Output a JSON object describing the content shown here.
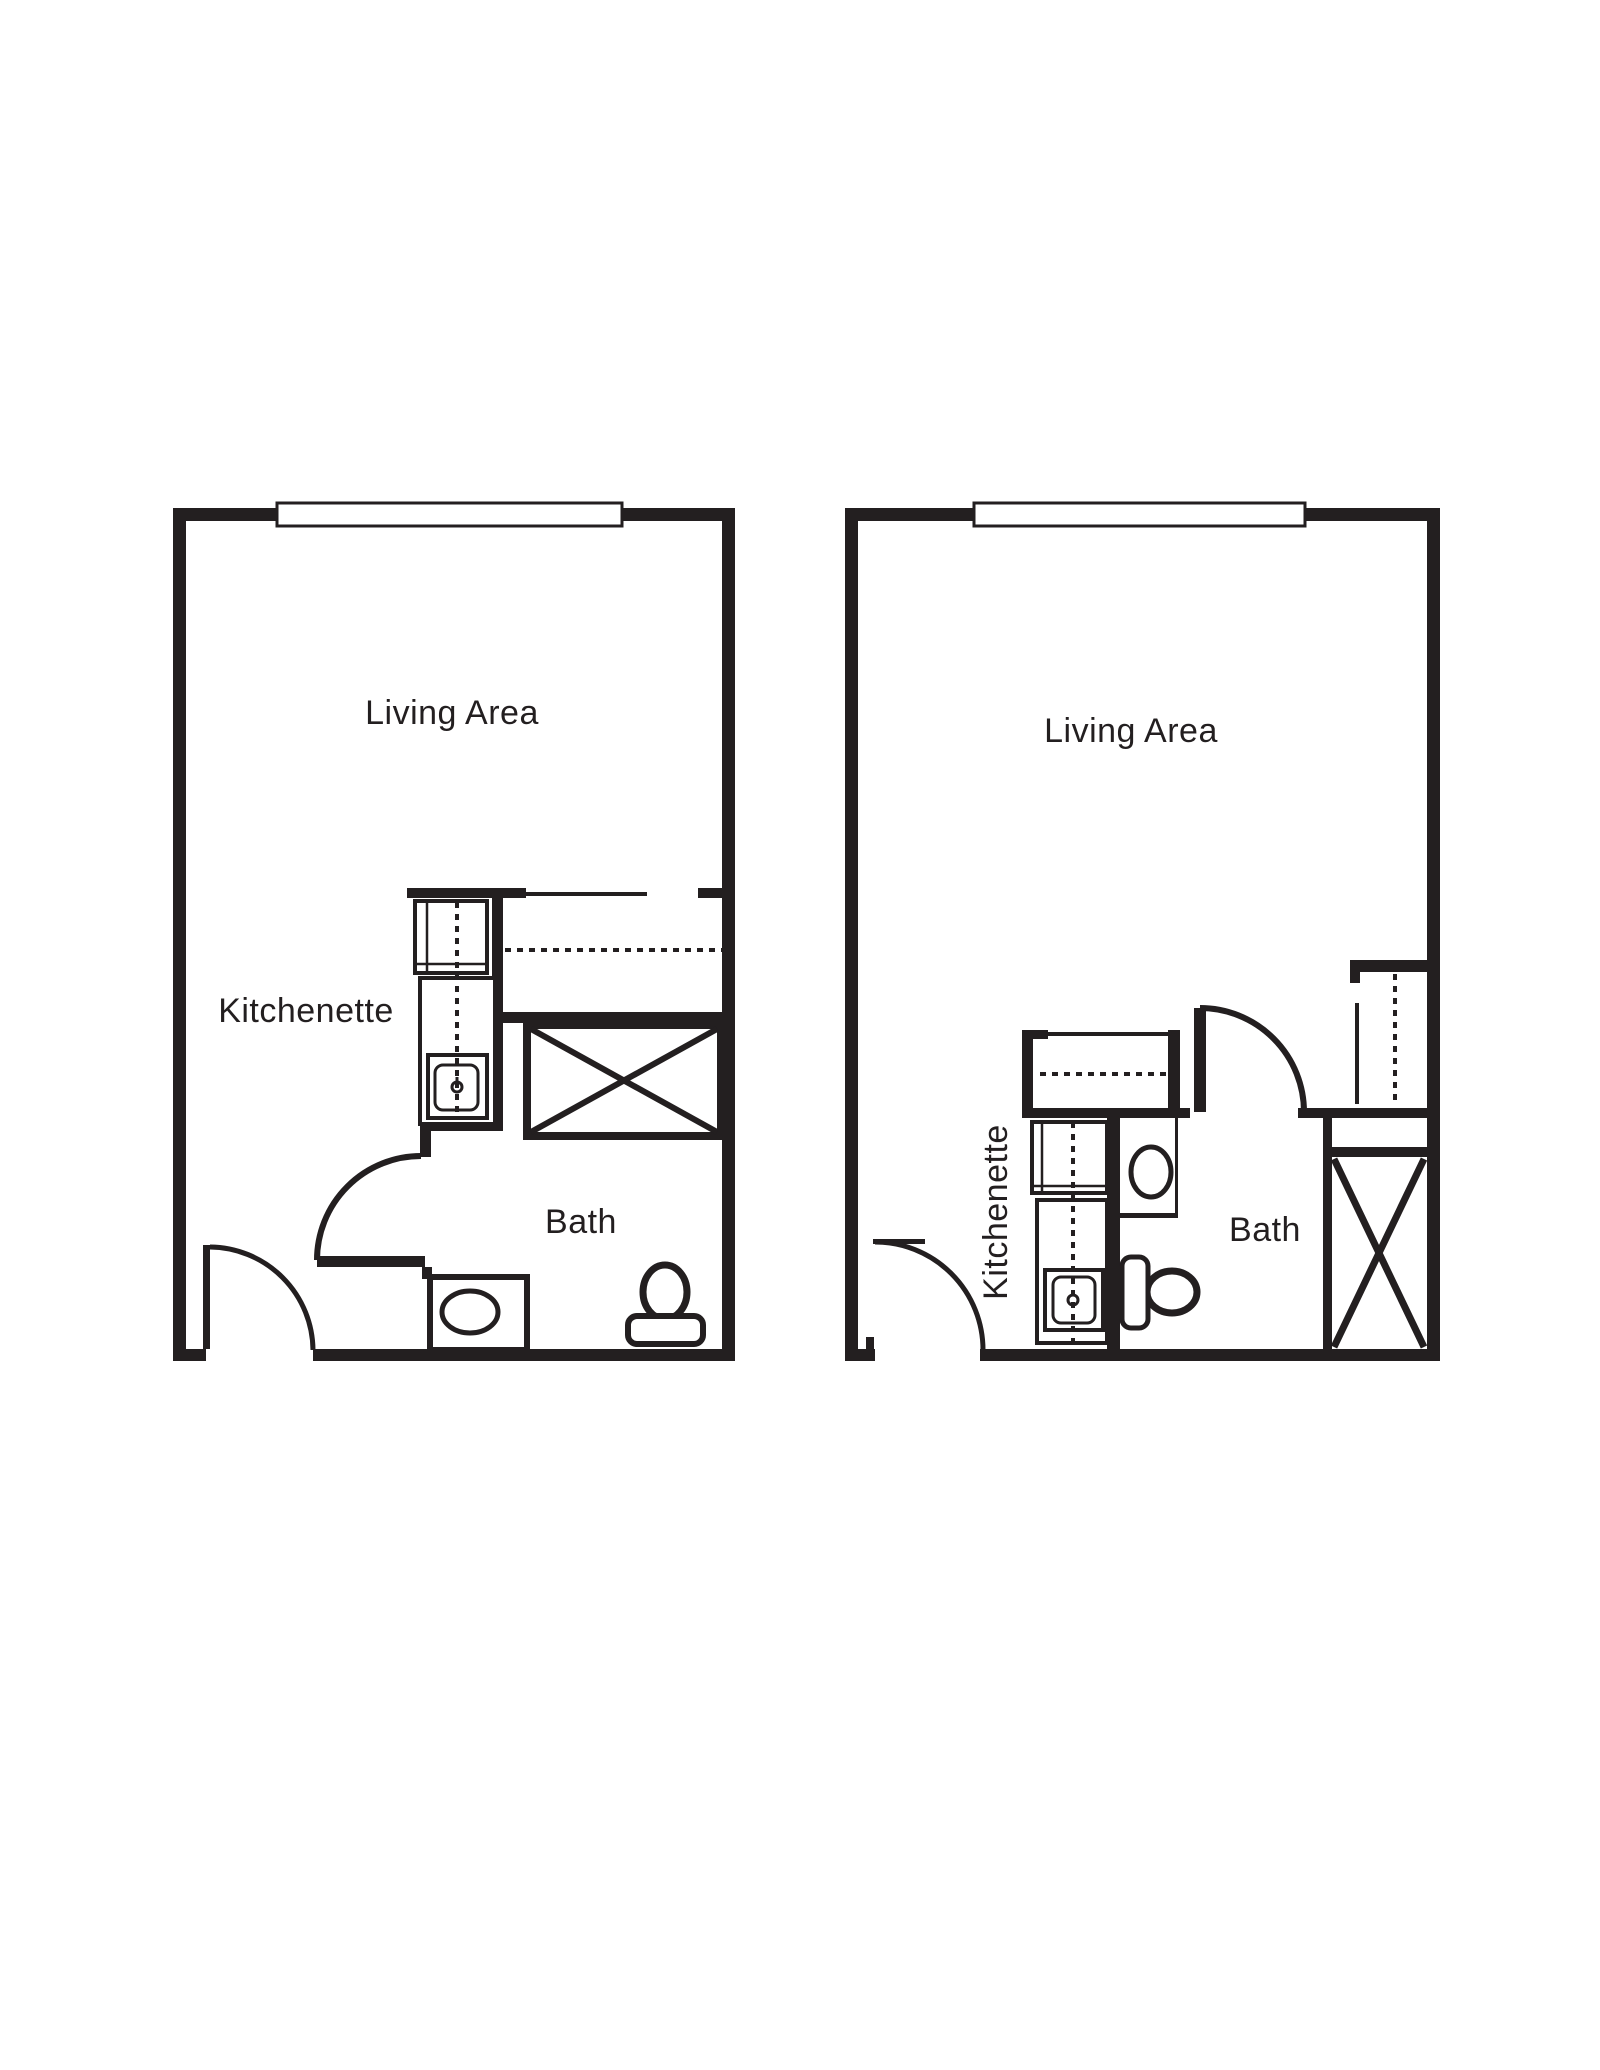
{
  "document": {
    "background_color": "#ffffff",
    "ink_color": "#231f20"
  },
  "floor_plans": {
    "left": {
      "living_area_label": "Living Area",
      "kitchenette_label": "Kitchenette",
      "bath_label": "Bath"
    },
    "right": {
      "living_area_label": "Living Area",
      "kitchenette_label": "Kitchenette",
      "bath_label": "Bath"
    }
  }
}
